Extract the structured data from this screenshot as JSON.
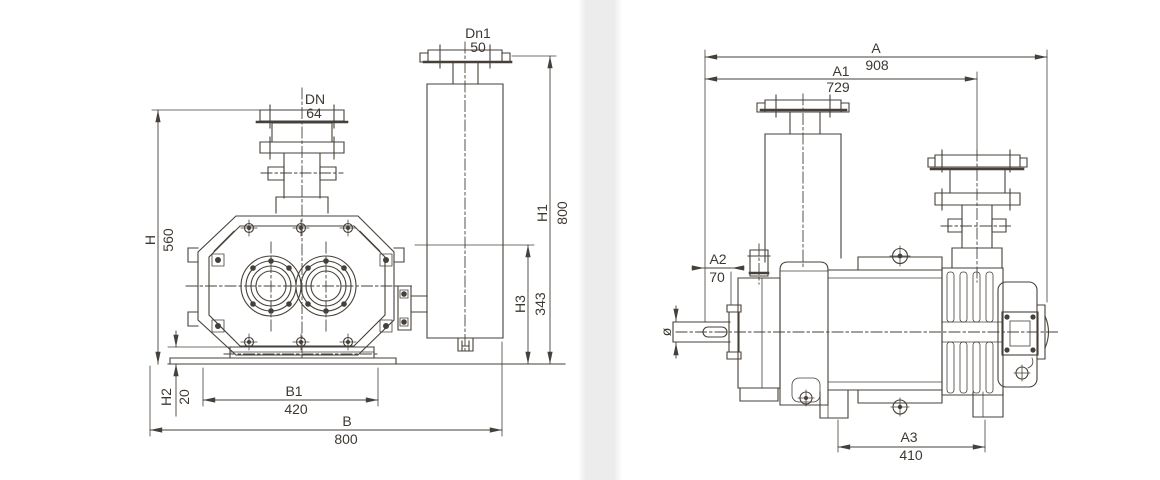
{
  "colors": {
    "line": "#46403a",
    "text": "#3e3832",
    "divider_band": "#ececec",
    "background": "#ffffff"
  },
  "front_view": {
    "dims": {
      "dn": {
        "label": "DN",
        "value": "64"
      },
      "dn1": {
        "label": "Dn1",
        "value": "50"
      },
      "h": {
        "label": "H",
        "value": "560"
      },
      "h1": {
        "label": "H1",
        "value": "800"
      },
      "h2": {
        "label": "H2",
        "value": "20"
      },
      "h3": {
        "label": "H3",
        "value": "343"
      },
      "b1": {
        "label": "B1",
        "value": "420"
      },
      "b": {
        "label": "B",
        "value": "800"
      }
    }
  },
  "side_view": {
    "dims": {
      "a": {
        "label": "A",
        "value": "908"
      },
      "a1": {
        "label": "A1",
        "value": "729"
      },
      "a2": {
        "label": "A2",
        "value": "70"
      },
      "a3": {
        "label": "A3",
        "value": "410"
      },
      "shaft_diameter": {
        "label": "ø"
      }
    }
  }
}
